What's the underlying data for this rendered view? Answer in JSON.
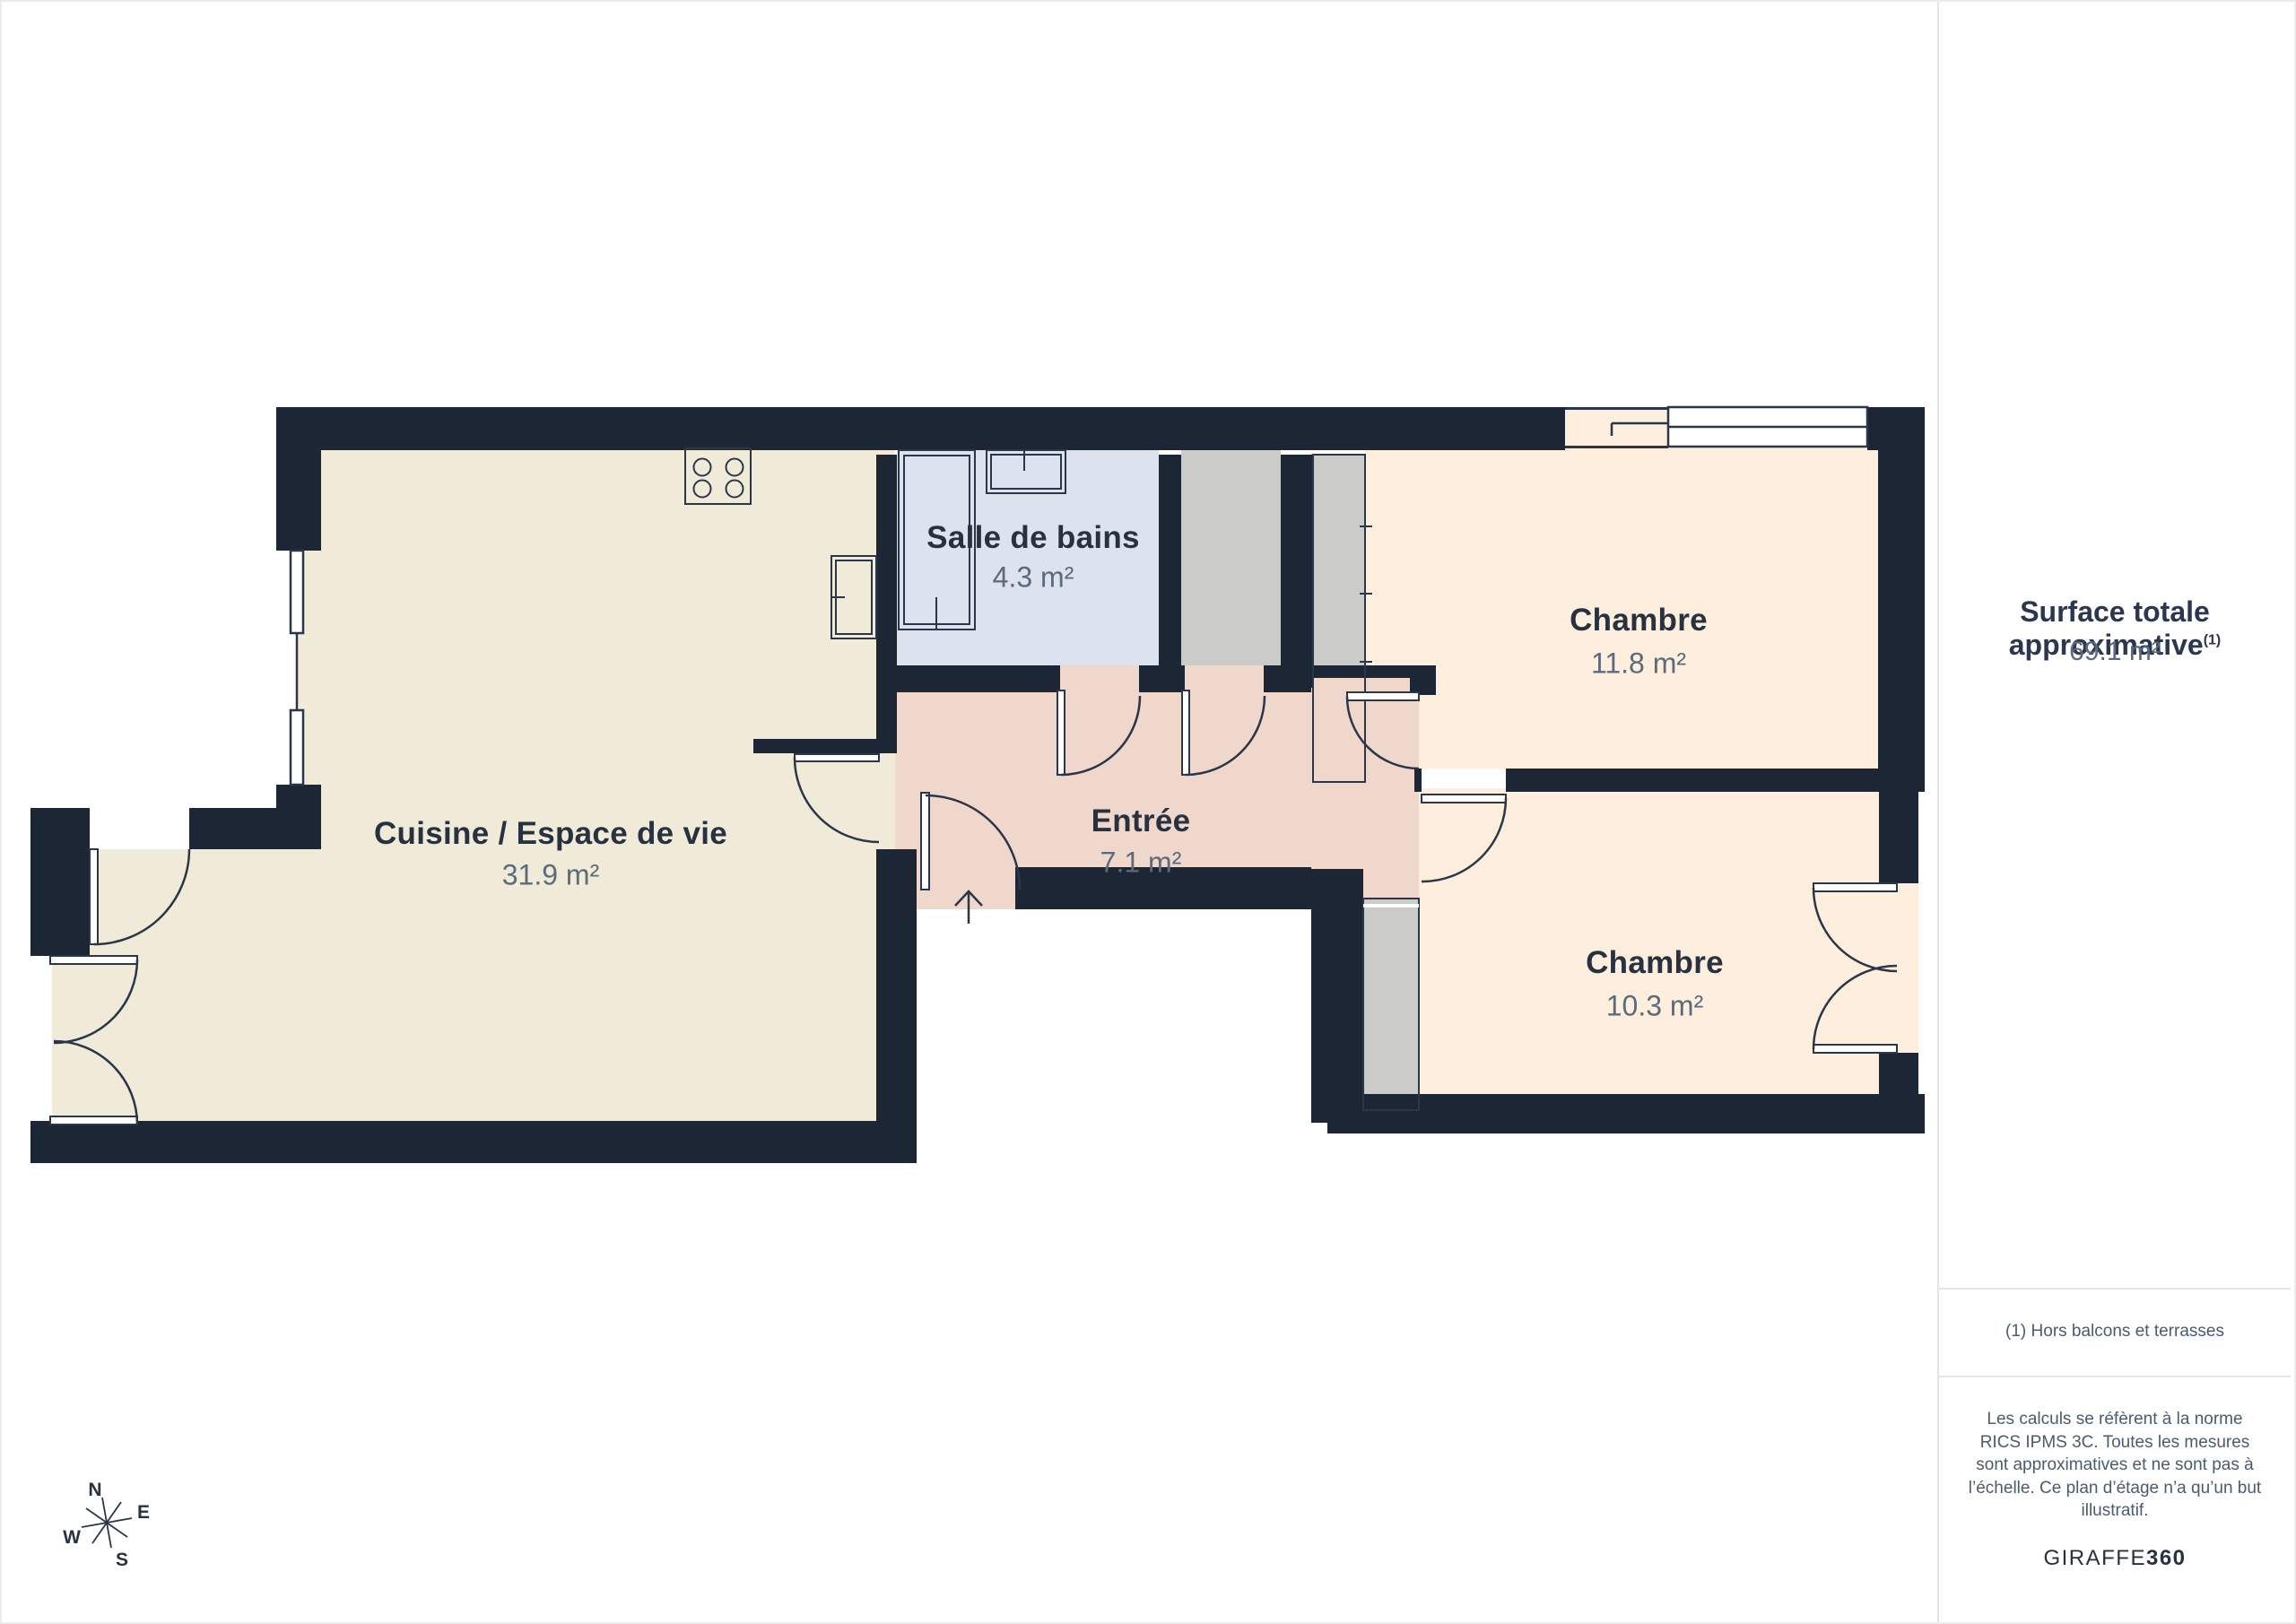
{
  "plan": {
    "rooms": [
      {
        "name": "Cuisine / Espace de vie",
        "area": "31.9 m²"
      },
      {
        "name": "Salle de bains",
        "area": "4.3 m²"
      },
      {
        "name": "Entrée",
        "area": "7.1 m²"
      },
      {
        "name": "Chambre",
        "area": "11.8 m²"
      },
      {
        "name": "Chambre",
        "area": "10.3 m²"
      }
    ],
    "compass": {
      "n": "N",
      "e": "E",
      "s": "S",
      "w": "W"
    }
  },
  "sidebar": {
    "title": "Surface totale approximative",
    "title_superscript": "(1)",
    "total_area": "69.1 m²",
    "footnote": "(1) Hors balcons et terrasses",
    "disclaimer": "Les calculs se réfèrent à la norme RICS IPMS 3C. Toutes les mesures sont approximatives et ne sont pas à l’échelle. Ce plan d’étage n’a qu’un but illustratif.",
    "brand": {
      "name": "GIRAFFE",
      "suffix": "360"
    }
  },
  "colors": {
    "wall": "#1d2634",
    "line": "#2b3648",
    "floor_living": "#f0ead8",
    "floor_bathroom": "#dce2ee",
    "floor_entry": "#efd7cb",
    "floor_bedroom": "#fdeedd",
    "floor_duct": "#cbccca",
    "text_primary": "#27313f",
    "text_secondary": "#5c6a7c"
  }
}
